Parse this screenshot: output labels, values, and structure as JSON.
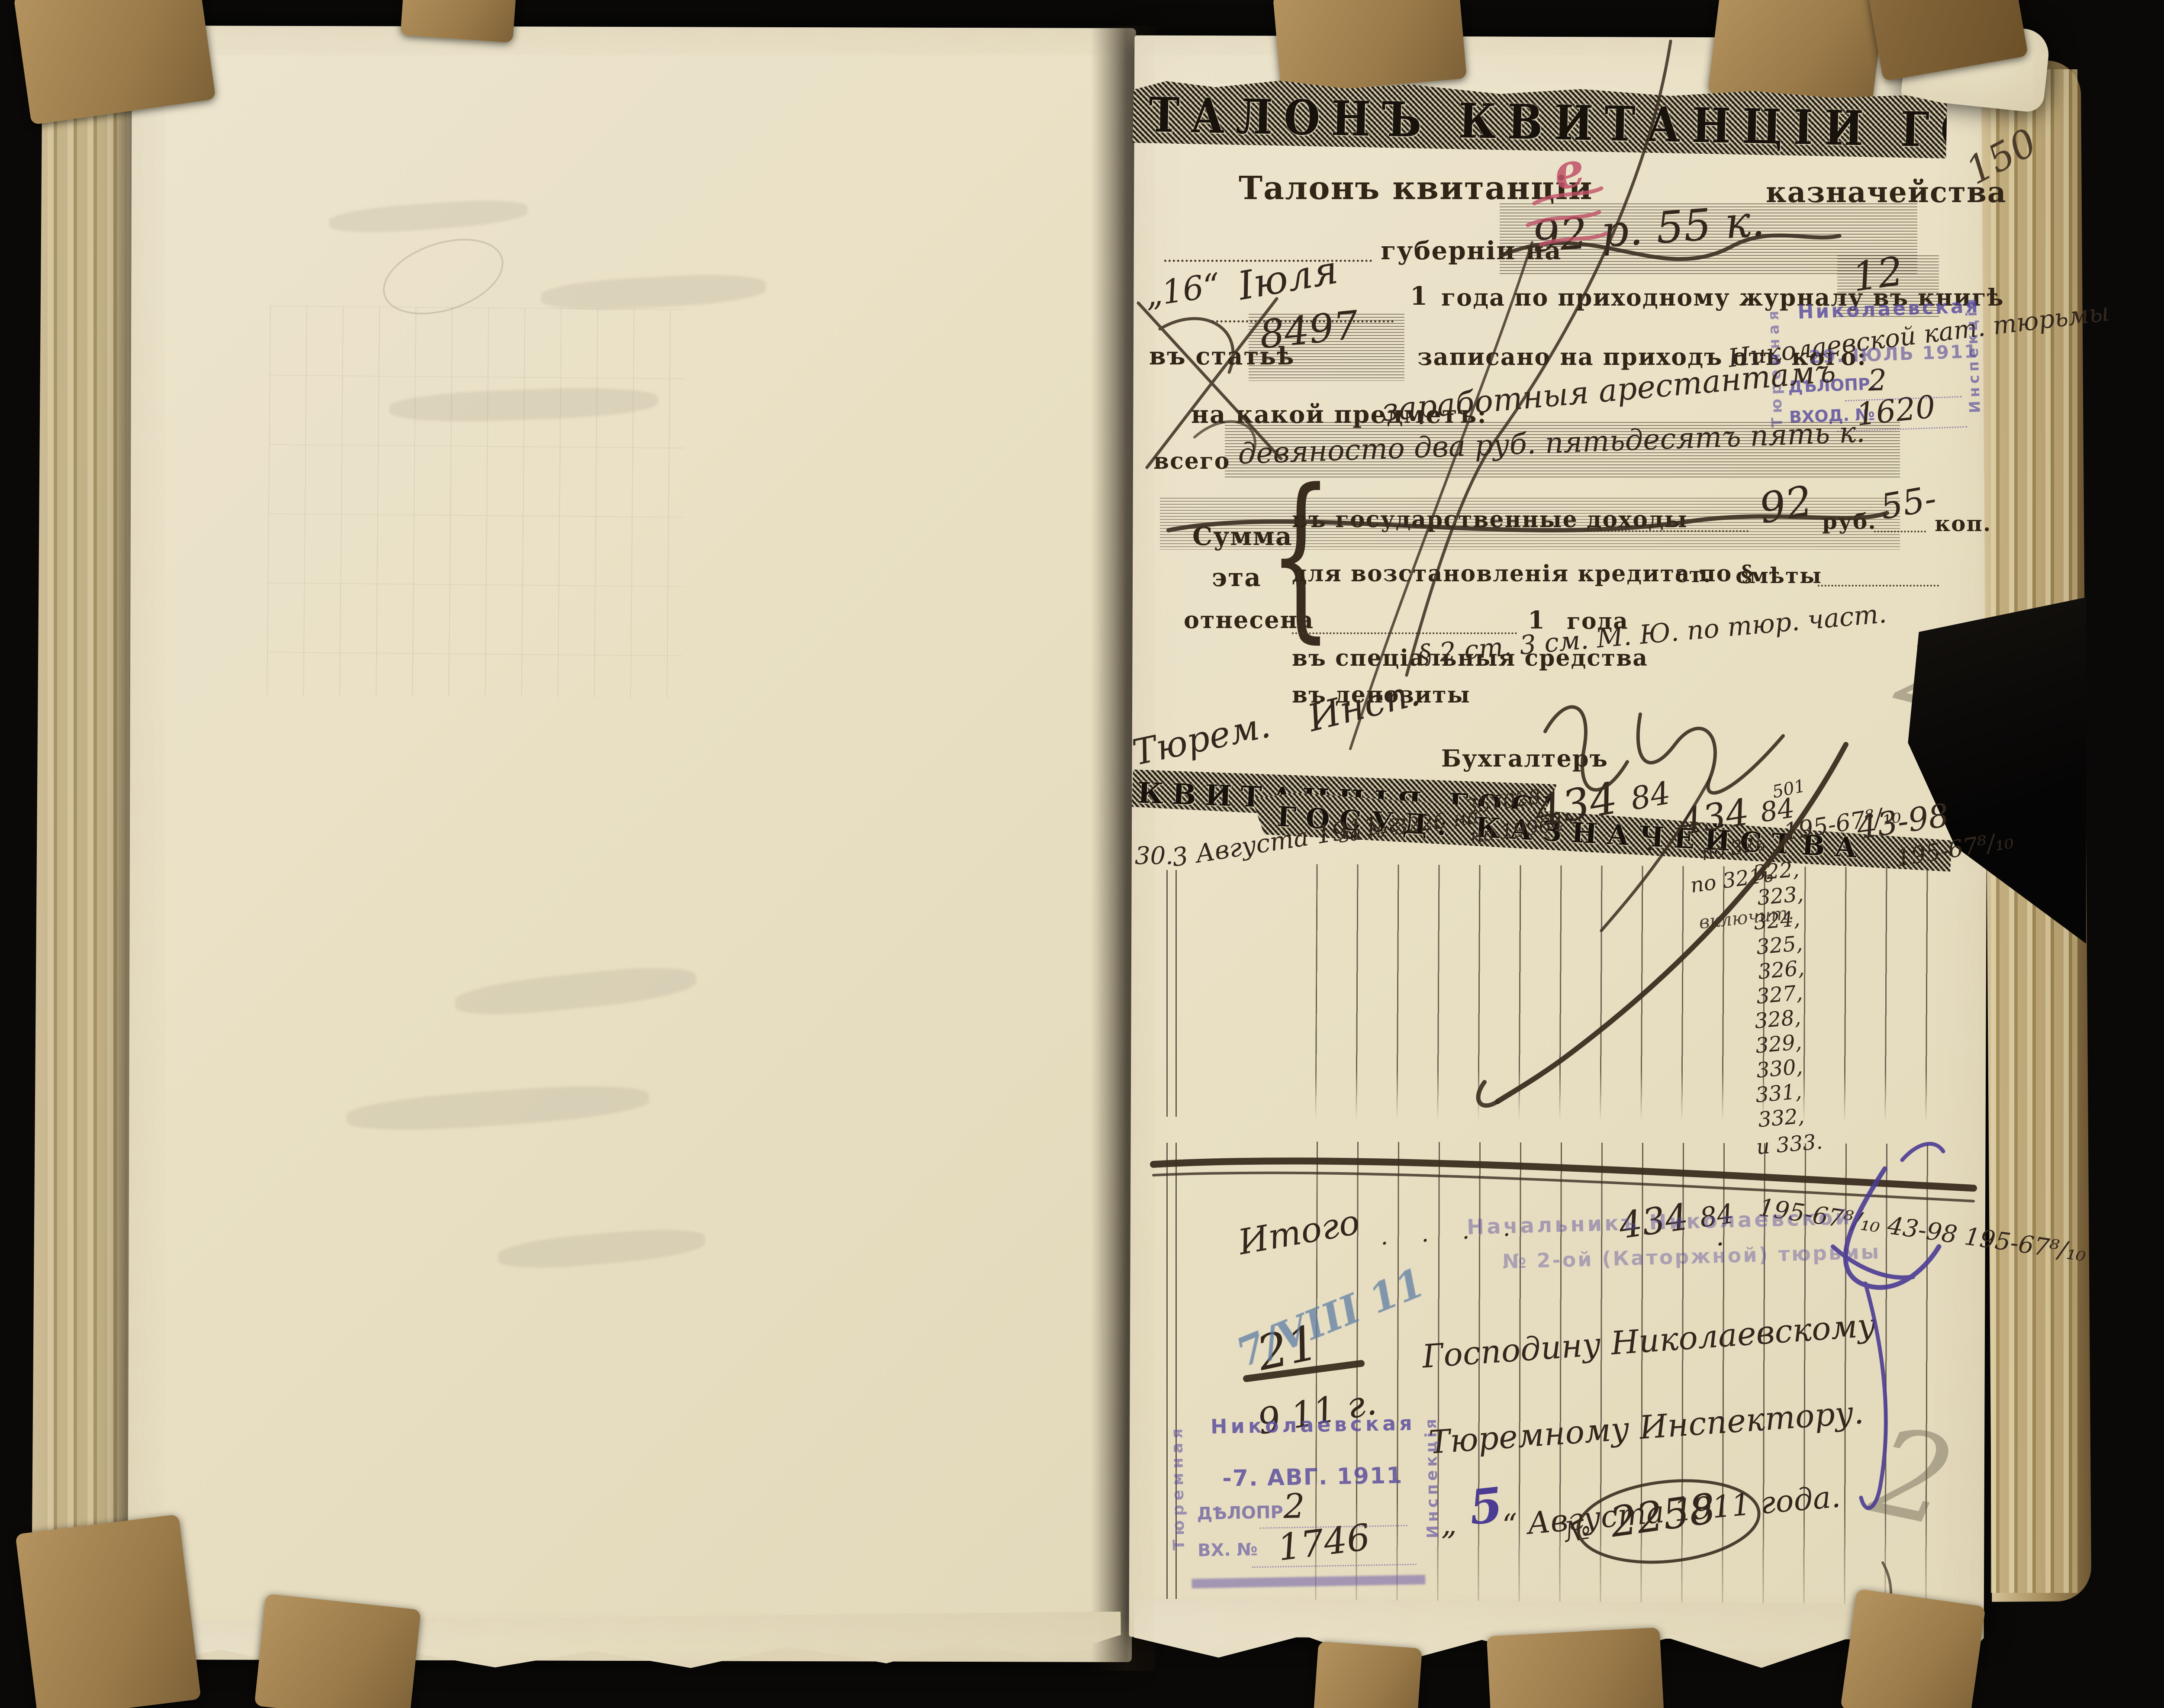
{
  "meta": {
    "page_number": "150",
    "pencil_mark_upper": "2",
    "pencil_mark_lower": "2"
  },
  "colors": {
    "background": "#0a0908",
    "paper": "#e9e0c4",
    "kraft": "#a8885c",
    "ink": "#3b2e21",
    "stamp_purple": "#5a4a9e",
    "red_pencil": "#c05168",
    "blue_pencil": "#5f7fa5"
  },
  "talon": {
    "band_title": "ТАЛОНЪ КВИТАНЦІИ ГОСУД. КАЗНАЧЕЙСТВА",
    "title_left": "Талонъ квитанціи",
    "title_right": "казначейства",
    "guberniya_label": "губерніи на",
    "guberniya_value": "92 р. 55 к.",
    "red_mark": "е",
    "day_value": "„16“",
    "month_value": "Іюля",
    "year_printed": "1",
    "journal_label": "года по приходному журналу въ книгѣ",
    "book_value": "12",
    "article_label": "въ статьѣ",
    "article_value": "8497",
    "prihod_label": "записано на приходъ отъ кого:",
    "payer_value": "Николаевской кат. тюрьмы",
    "subject_label": "на какой предметъ:",
    "subject_value": "заработныя арестантамъ",
    "total_label": "всего",
    "total_value": "девяносто два руб. пятьдесятъ пять к.",
    "brace": "{",
    "sum_word_1": "Сумма",
    "sum_word_2": "эта",
    "sum_word_3": "отнесена",
    "income_label": "въ государственные доходы",
    "income_rub": "92",
    "rub_label": "руб.",
    "income_kop": "55-",
    "kop_label": "коп.",
    "credit_label": "для возстановленія кредита по §",
    "st_label": "ст.",
    "smeta_label": "смѣты",
    "year_value": "1",
    "year_label": "года",
    "special_label": "въ спеціальныя средства",
    "special_value": "§ 2 ст. 3 см. М. Ю. по тюр. част.",
    "deposit_label": "въ депозиты",
    "accountant_label": "Бухгалтеръ",
    "note_word_1": "Тюрем.",
    "note_word_2": "Инсп."
  },
  "stamp_july": {
    "top": "Николаевская",
    "left_vertical": "Тюремная",
    "right_vertical": "Инспекція",
    "date": "29. ІЮЛЬ 1911",
    "delopr_label": "ДѢЛОПР.",
    "delopr_value": "2",
    "vhod_label": "ВХОД. №",
    "vhod_value": "1620"
  },
  "quittance": {
    "band_title_upper": "КВИТАНЦІЯ ГОСУД",
    "band_title_lower": "ГОСУД. КАЗНАЧЕЙСТВА",
    "ledger": {
      "row_no": "30.",
      "date": "3 Августа 1911 г.",
      "ref": "за № 3226 на",
      "acct_top": "357028",
      "acct_bottom": "на 19964",
      "sum1": "434",
      "kop1": "84",
      "dot": ".",
      "sum2": "434",
      "kop2": "84",
      "small_note": "501",
      "po_note": "по 32ь",
      "amt1": "195-67⁸/₁₀",
      "amt2": "43-98",
      "amt3": "195-67⁸/₁₀"
    },
    "side_note_1": "по 321ь",
    "side_note_2": "включит.",
    "articles": [
      "322,",
      "323,",
      "324,",
      "325,",
      "326,",
      "327,",
      "328,",
      "329,",
      "330,",
      "331,",
      "332,",
      "и 333."
    ],
    "itogo_label": "Итого",
    "itogo_dots": "·      ·      ·      ·",
    "itogo_sum": "434",
    "itogo_kop": "84",
    "itogo_dot2": "·",
    "itogo_tail": "195-67⁸/₁₀ 43-98 195-67⁸/₁₀",
    "date_fraction_top": "21",
    "date_fraction_bottom": "9 11 г."
  },
  "stamp_warden": {
    "line1": "Начальникъ Николаевской",
    "line2": "№ 2-ой (Каторжной) тюрьмы"
  },
  "address": {
    "line1": "Господину Николаевскому",
    "line2": "Тюремному Инспектору.",
    "quote_open": "„",
    "day": "5",
    "line3": "“ Августа 1911 года."
  },
  "blue_note": "7/VIII 11",
  "stamp_august": {
    "top": "Николаевская",
    "left_vertical": "Тюремная",
    "right_vertical": "Инспекція",
    "date": "-7. АВГ. 1911",
    "delopr_label": "ДѢЛОПР.",
    "delopr_value": "2",
    "vh_label": "ВХ. №",
    "vh_value": "1746"
  },
  "outgoing": {
    "prefix": "№",
    "number": "2258"
  }
}
